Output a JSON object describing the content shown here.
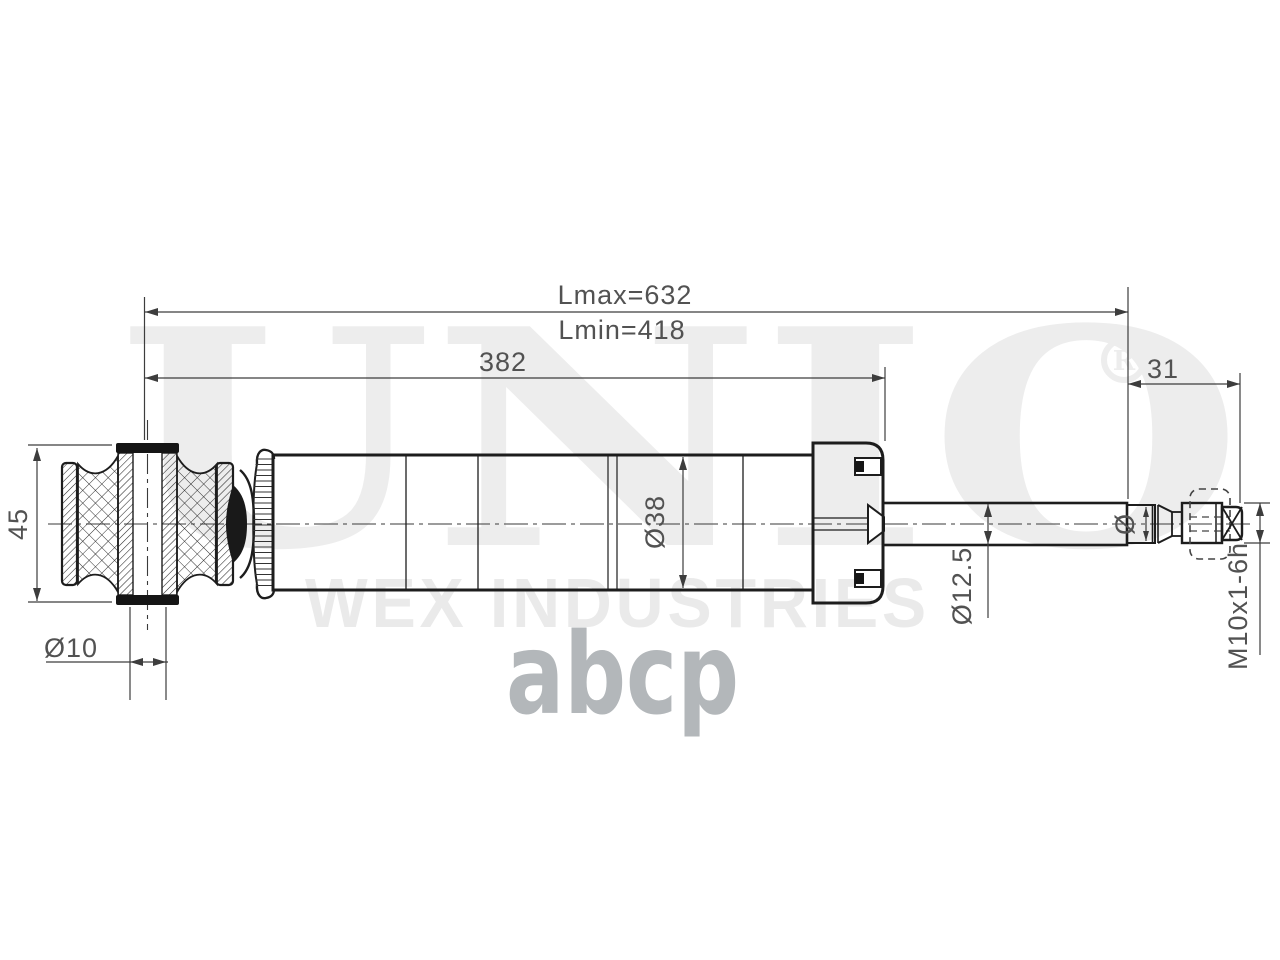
{
  "image": {
    "type": "technical-drawing",
    "subject": "shock absorber side view with dimensions"
  },
  "dimensions": {
    "lmax": "Lmax=632",
    "lmin": "Lmin=418",
    "body_length": "382",
    "thread_end_length": "31",
    "bushing_width": "45",
    "bushing_bore_diameter": "Ø10",
    "body_diameter": "Ø38",
    "rod_diameter": "Ø12.5",
    "stem_diameter_symbol": "Ø",
    "thread_spec": "M10x1-6h"
  },
  "watermark": {
    "brand": "UNIO",
    "registered_symbol": "R",
    "tagline": "WEX INDUSTRIES",
    "marketplace_logo": "abcp"
  },
  "colors": {
    "background": "#ffffff",
    "drawing_line": "#1d1d1d",
    "dimension_line": "#3d3d3d",
    "dimension_text": "#525252",
    "watermark_gray": "#ededed",
    "logo_gray": "#b3b7ba"
  }
}
